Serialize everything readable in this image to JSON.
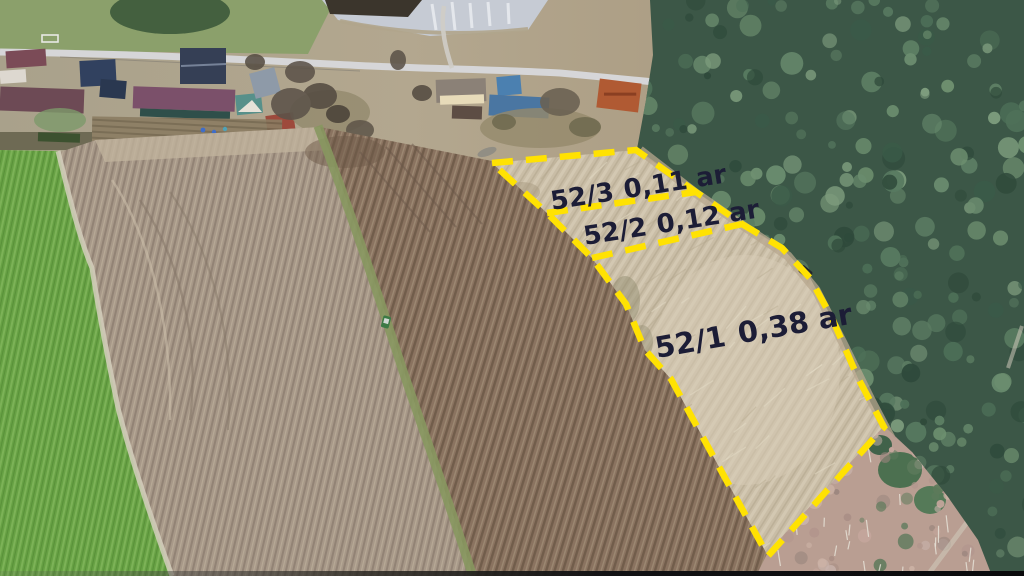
{
  "scene": {
    "description": "Aerial drone photo of rural farmland: village with houses and pond at top, green and plowed fields in the middle, pine forest on the right, three land parcels outlined with yellow dashed survey lines",
    "features": [
      "village-houses",
      "pond",
      "road",
      "green-field",
      "plowed-fields",
      "pine-forest",
      "birch-scrub",
      "marked-parcels",
      "car-on-forest-road",
      "tractor-in-field"
    ]
  },
  "parcels": [
    {
      "id": "52/3",
      "area": "0,11 ar"
    },
    {
      "id": "52/2",
      "area": "0,12 ar"
    },
    {
      "id": "52/1",
      "area": "0,38 ar"
    }
  ],
  "colors": {
    "boundary": "#FFE202",
    "label_text": "#1C1D36"
  }
}
